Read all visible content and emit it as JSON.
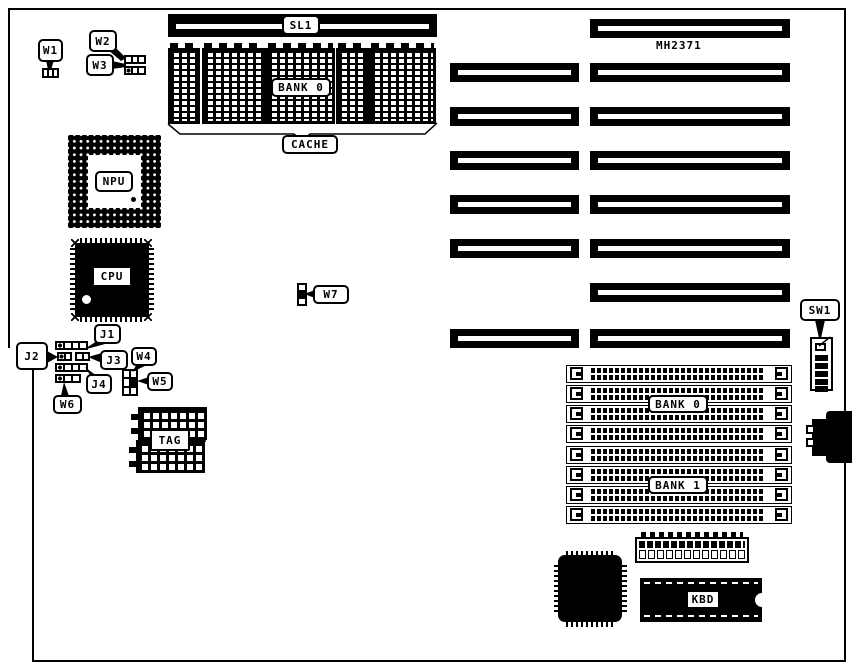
{
  "diagram": {
    "board_model": "MH2371",
    "labels": {
      "w1": "W1",
      "w2": "W2",
      "w3": "W3",
      "npu": "NPU",
      "cpu": "CPU",
      "j1": "J1",
      "j2": "J2",
      "j3": "J3",
      "j4": "J4",
      "w4": "W4",
      "w5": "W5",
      "w6": "W6",
      "w7": "W7",
      "sl1": "SL1",
      "cache_bank0": "BANK 0",
      "cache": "CACHE",
      "tag": "TAG",
      "sw1": "SW1",
      "simm_bank0": "BANK 0",
      "simm_bank1": "BANK 1",
      "kbd": "KBD"
    },
    "components": {
      "cache_chips": 5,
      "expansion_slots_left_column": 6,
      "expansion_slots_right_column": 8,
      "simm_sockets": 8
    },
    "colors": {
      "ink": "#000000",
      "background": "#ffffff"
    }
  }
}
